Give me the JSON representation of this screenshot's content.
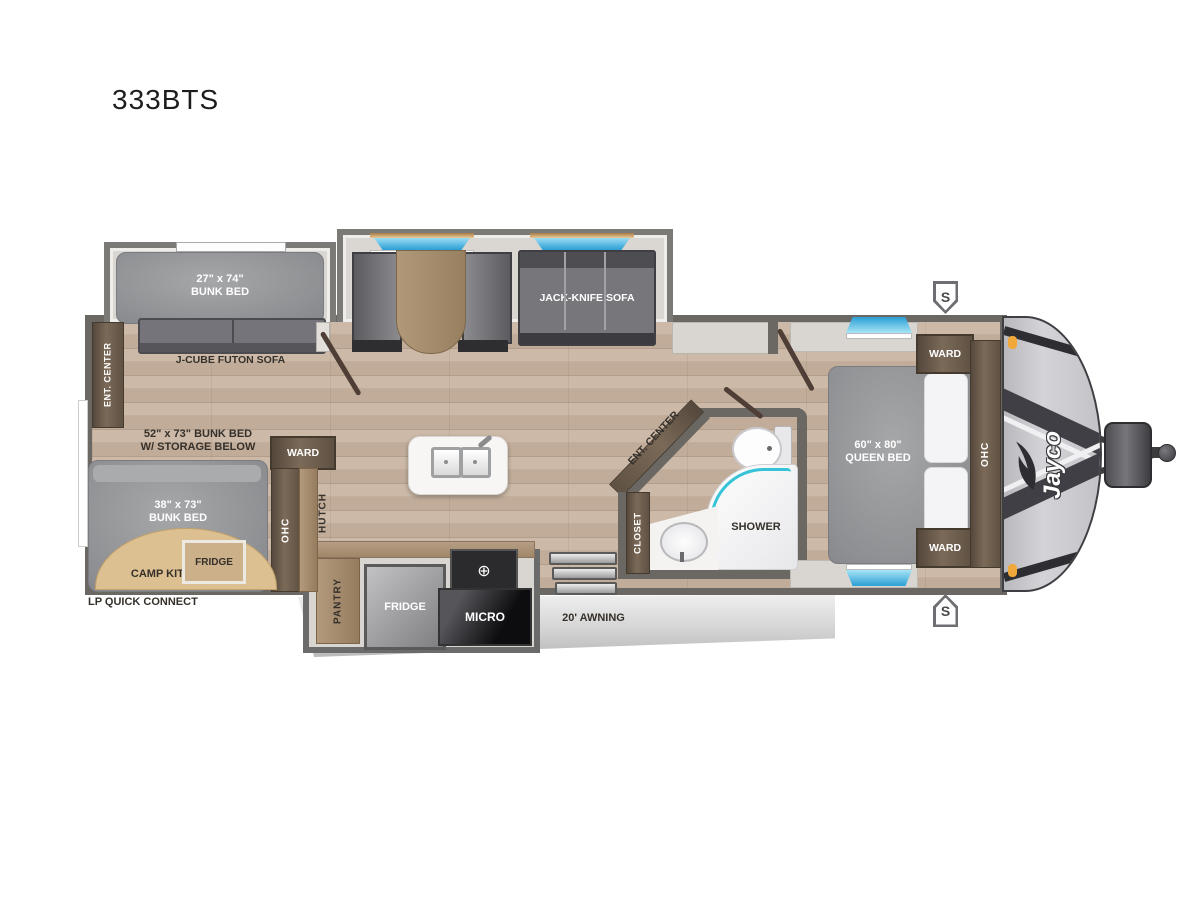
{
  "title": "333BTS",
  "brand_logo": "Jayco",
  "speaker_badge": "S",
  "exterior": {
    "awning": "20' AWNING",
    "lp_quick_connect": "LP QUICK CONNECT"
  },
  "bunk_room": {
    "bunk_slide_bed": "27\" x 74\"\nBUNK BED",
    "futon": "J-CUBE FUTON SOFA",
    "ent_center": "ENT. CENTER",
    "bunk_over": "52\" x 73\" BUNK BED\nW/ STORAGE BELOW",
    "bunk_lower": "38\" x 73\"\nBUNK BED",
    "camp_kitchen": "CAMP KITCHEN",
    "camp_fridge": "FRIDGE",
    "ward": "WARD",
    "ohc": "OHC",
    "hutch": "HUTCH"
  },
  "living": {
    "jack_knife_sofa": "JACK-KNIFE SOFA",
    "ent_center": "ENT. CENTER"
  },
  "kitchen": {
    "pantry": "PANTRY",
    "fridge": "FRIDGE",
    "micro": "MICRO"
  },
  "bathroom": {
    "closet": "CLOSET",
    "shower": "SHOWER"
  },
  "bedroom": {
    "ward_top": "WARD",
    "ward_bottom": "WARD",
    "queen_bed": "60\" x 80\"\nQUEEN BED",
    "ohc": "OHC"
  },
  "colors": {
    "wall": "#6b6863",
    "floor_wood": "#c7b3a1",
    "cabinet_brown": "#5f5143",
    "window_blue": "#2a9fd4",
    "shower_glass_teal": "#35c3d8",
    "awning_gray": "#d6d6d6",
    "marker_light_orange": "#f0a83a"
  }
}
